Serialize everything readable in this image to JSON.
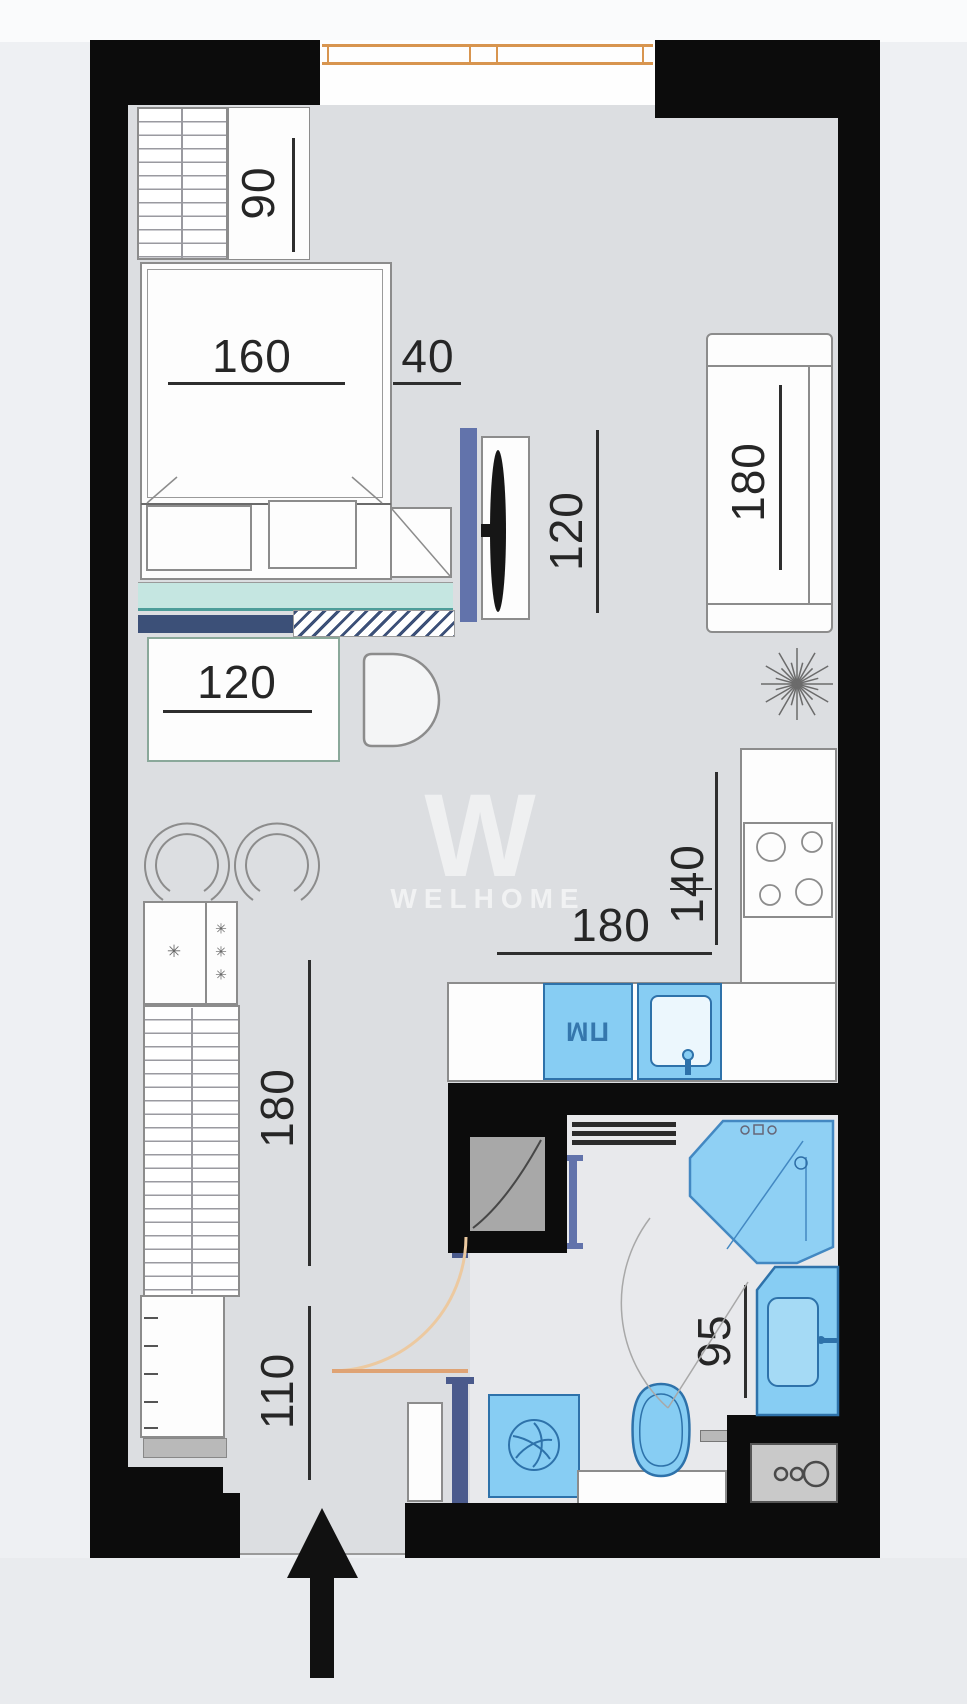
{
  "watermark": {
    "logo_letter": "W",
    "brand": "WELHOME"
  },
  "labels": {
    "dishwasher": "ПМ"
  },
  "icons": {
    "freezer_star": "✳",
    "entrance_arrow": "up-arrow",
    "plant": "starburst",
    "meter_box": "circles"
  },
  "dimensions": [
    {
      "area": "closet",
      "value": "90",
      "orientation": "vertical"
    },
    {
      "area": "bed",
      "value": "160",
      "orientation": "horizontal"
    },
    {
      "area": "nightstand",
      "value": "40",
      "orientation": "horizontal"
    },
    {
      "area": "tv-unit",
      "value": "120",
      "orientation": "vertical"
    },
    {
      "area": "sofa",
      "value": "180",
      "orientation": "vertical"
    },
    {
      "area": "dining-table",
      "value": "120",
      "orientation": "horizontal"
    },
    {
      "area": "kitchen-depth",
      "value": "140",
      "orientation": "vertical"
    },
    {
      "area": "kitchen-run",
      "value": "180",
      "orientation": "horizontal"
    },
    {
      "area": "shower",
      "value": "90",
      "orientation": "horizontal"
    },
    {
      "area": "bathroom",
      "value": "95",
      "orientation": "vertical"
    },
    {
      "area": "hallway",
      "value": "180",
      "orientation": "vertical"
    },
    {
      "area": "entry",
      "value": "110",
      "orientation": "vertical"
    }
  ],
  "colors": {
    "wall": "#0c0c0c",
    "floor_main": "#dcdee1",
    "floor_bath": "#e8e9ec",
    "fixture_blue": "#87cdf3",
    "fixture_blue_border": "#2e72aa",
    "shower_blue": "#8fd0f4",
    "teal_bench": "#c5e6e1",
    "navy": "#3c5078",
    "slate": "#6273ab",
    "window_orange": "#d8954f",
    "door_orange": "#ecc9a0",
    "dim_text": "#262626",
    "shower_dim_text": "#1d3f66"
  }
}
